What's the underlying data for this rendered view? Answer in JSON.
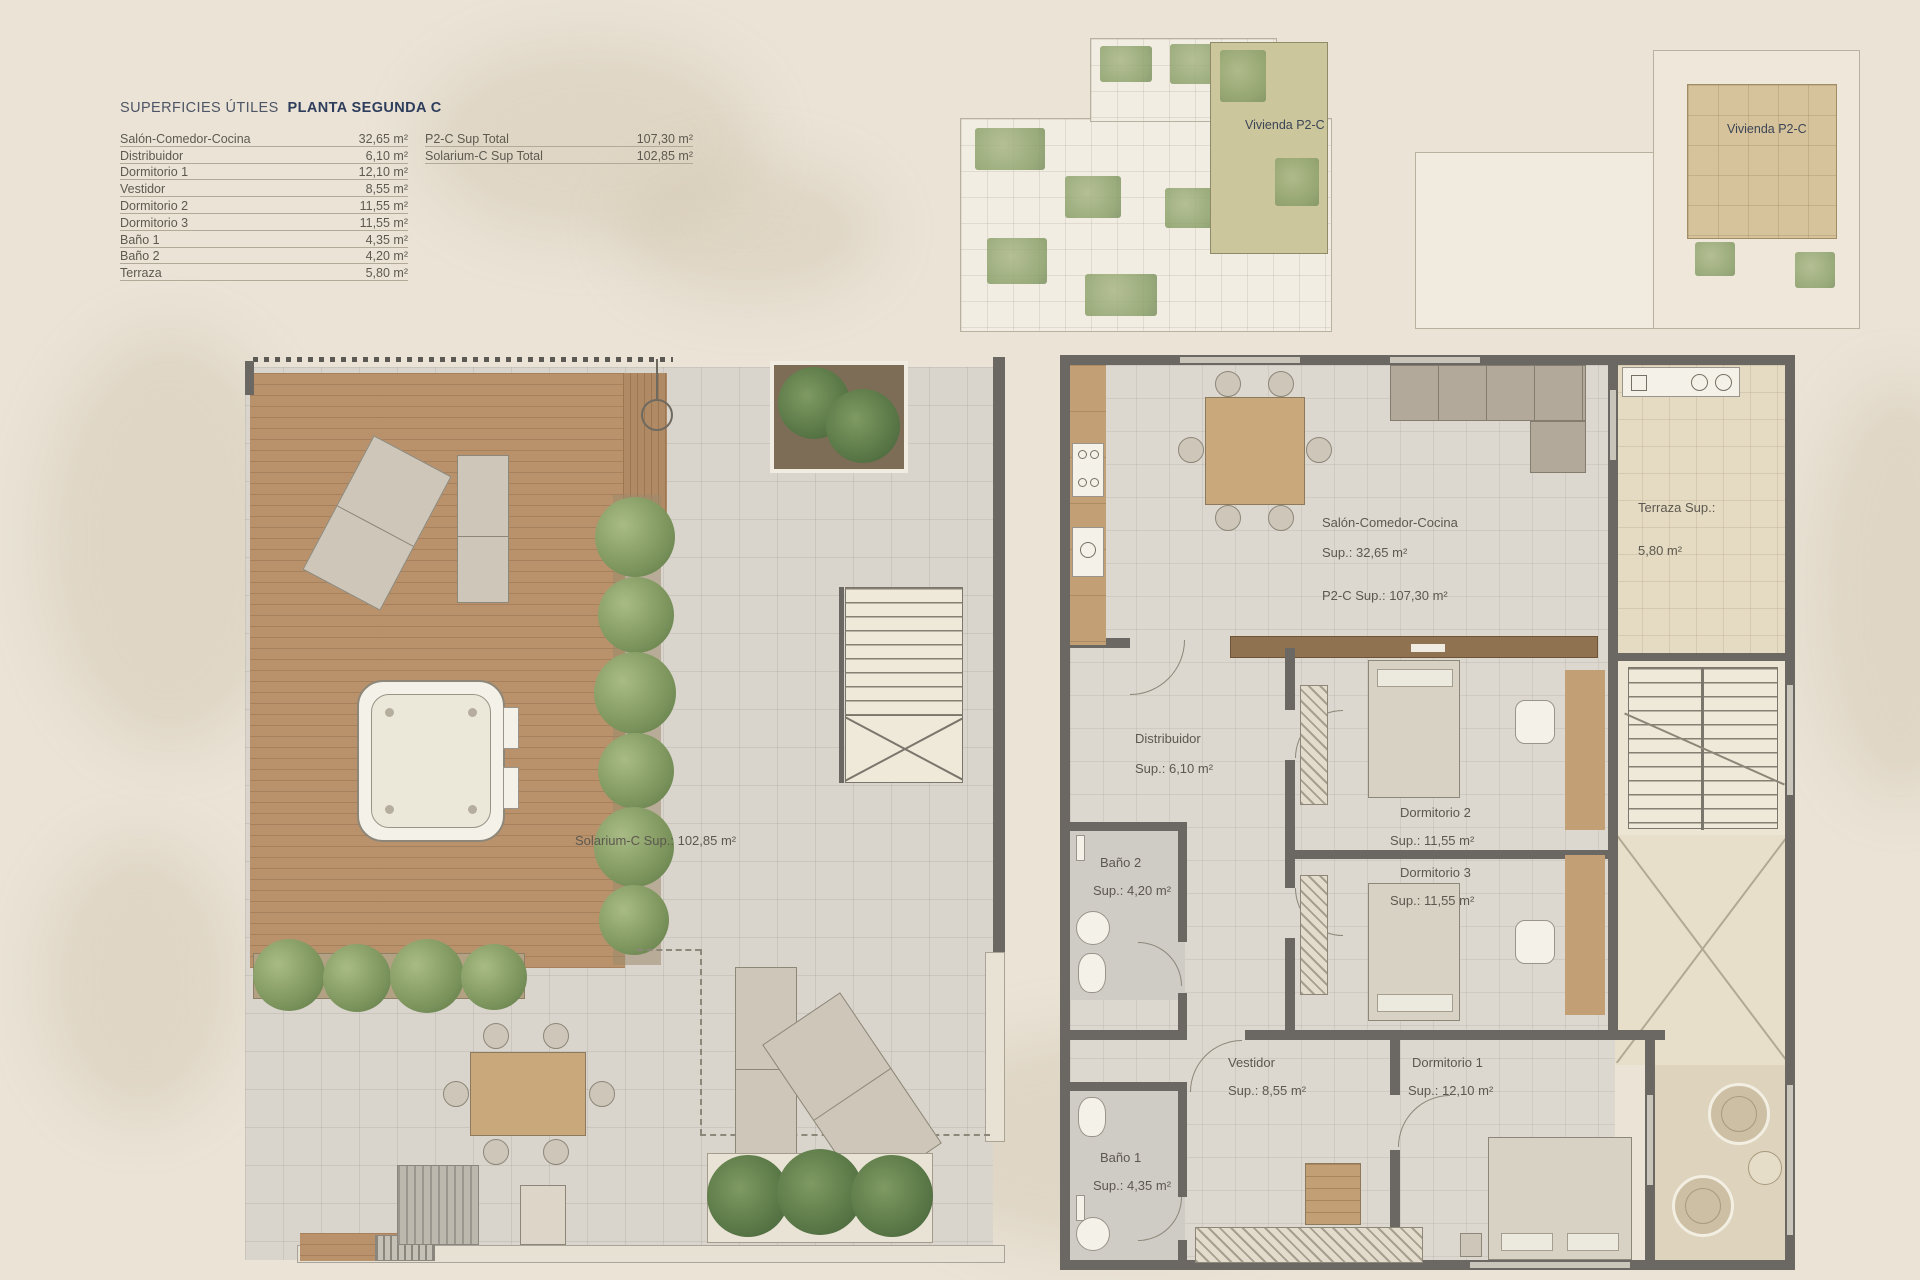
{
  "legend": {
    "title_left": "SUPERFICIES ÚTILES",
    "title_right": "PLANTA SEGUNDA  C",
    "rows": [
      {
        "label": "Salón-Comedor-Cocina",
        "value": "32,65 m²"
      },
      {
        "label": "Distribuidor",
        "value": "6,10 m²"
      },
      {
        "label": "Dormitorio 1",
        "value": "12,10 m²"
      },
      {
        "label": "Vestidor",
        "value": "8,55 m²"
      },
      {
        "label": "Dormitorio 2",
        "value": "11,55 m²"
      },
      {
        "label": "Dormitorio 3",
        "value": "11,55 m²"
      },
      {
        "label": "Baño 1",
        "value": "4,35 m²"
      },
      {
        "label": "Baño 2",
        "value": "4,20 m²"
      },
      {
        "label": "Terraza",
        "value": "5,80 m²"
      }
    ],
    "totals": [
      {
        "label": "P2-C Sup Total",
        "value": "107,30 m²"
      },
      {
        "label": "Solarium-C Sup Total",
        "value": "102,85 m²"
      }
    ]
  },
  "key_plans": {
    "plan1_label": "Vivienda P2-C",
    "plan2_label": "Vivienda P2-C"
  },
  "solarium": {
    "area_label": "Solarium-C Sup.: 102,85 m²"
  },
  "apartment": {
    "salon": {
      "name": "Salón-Comedor-Cocina",
      "sup": "Sup.: 32,65 m²",
      "total": "P2-C Sup.: 107,30 m²"
    },
    "terraza": {
      "name": "Terraza Sup.:",
      "sup": "5,80 m²"
    },
    "distribuidor": {
      "name": "Distribuidor",
      "sup": "Sup.: 6,10 m²"
    },
    "dormitorio2": {
      "name": "Dormitorio 2",
      "sup": "Sup.: 11,55 m²"
    },
    "dormitorio3": {
      "name": "Dormitorio 3",
      "sup": "Sup.: 11,55 m²"
    },
    "bano2": {
      "name": "Baño 2",
      "sup": "Sup.: 4,20 m²"
    },
    "vestidor": {
      "name": "Vestidor",
      "sup": "Sup.: 8,55 m²"
    },
    "dormitorio1": {
      "name": "Dormitorio 1",
      "sup": "Sup.: 12,10 m²"
    },
    "bano1": {
      "name": "Baño 1",
      "sup": "Sup.: 4,35 m²"
    }
  },
  "colors": {
    "background": "#eae3d6",
    "walls": "#6b6762",
    "deck_wood": "#b9926c",
    "greenery": "#7e965e",
    "terrace_floor": "#e5dbc2",
    "title_accent": "#2e3d5c"
  }
}
